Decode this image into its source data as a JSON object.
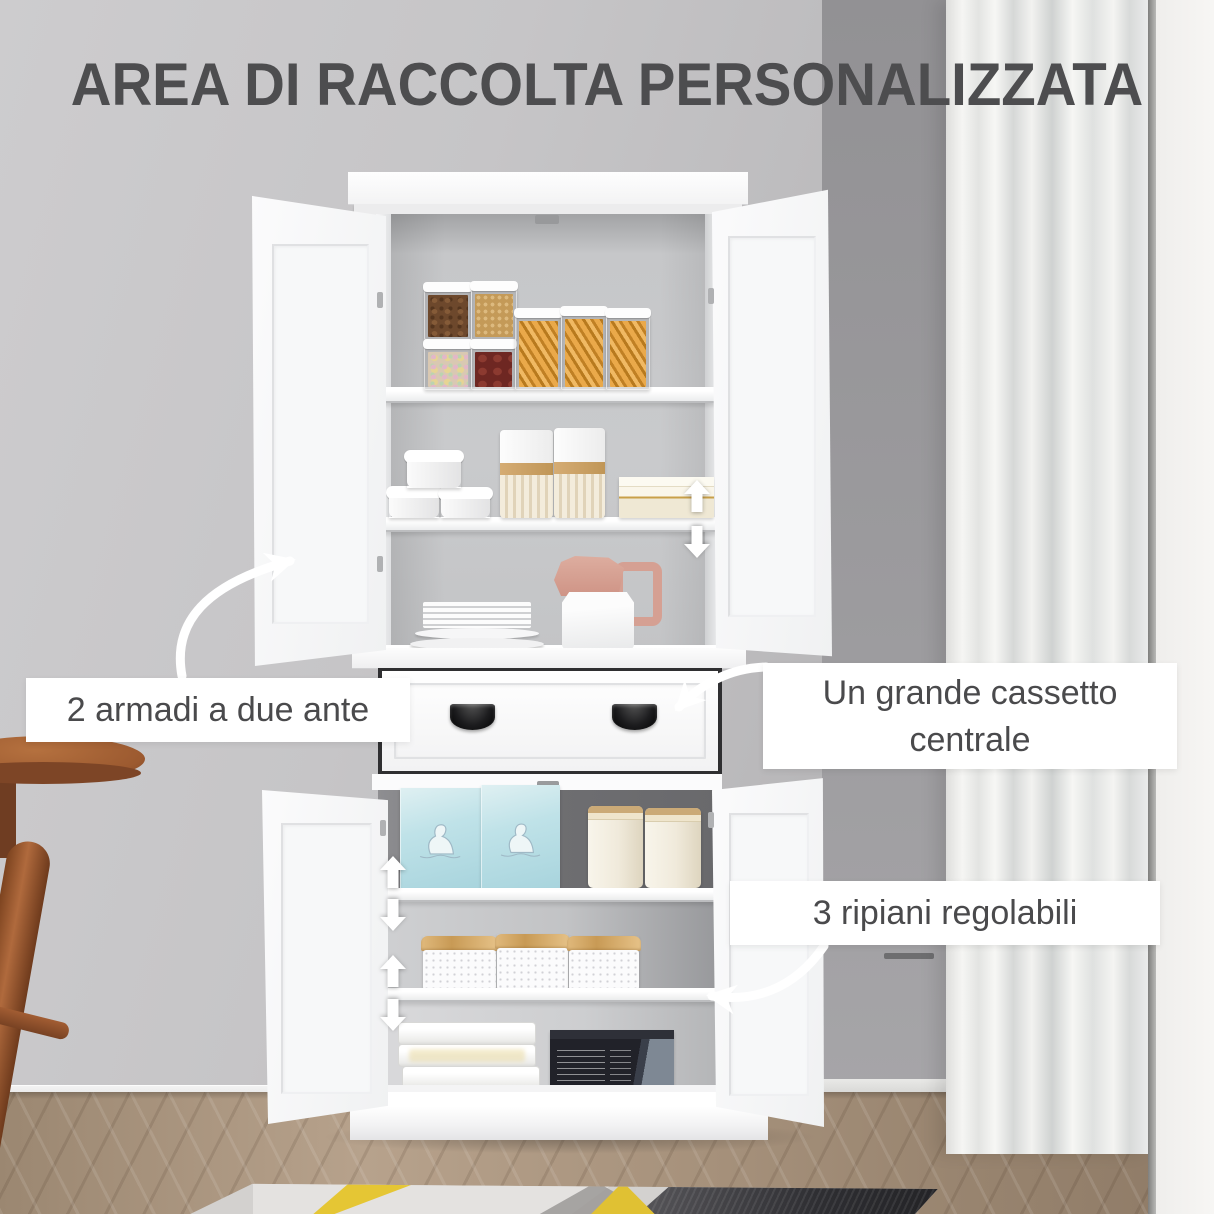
{
  "title": {
    "text": "AREA DI RACCOLTA PERSONALIZZATA"
  },
  "callouts": [
    {
      "id": "two-door-cabinets",
      "text": "2 armadi a due ante"
    },
    {
      "id": "central-drawer",
      "text": "Un grande cassetto centrale"
    },
    {
      "id": "adjustable-shelves",
      "text": "3 ripiani regolabili"
    }
  ],
  "colors": {
    "title_text": "#4d4d4f",
    "callout_text": "#4a4a4c",
    "callout_bg": "#ffffff",
    "annotation_arrow": "#ffffff",
    "cabinet_white": "#fafafb",
    "wall_gray": "#c3c2c4",
    "chair_wood": "#a9653a",
    "rug_yellow": "#e5c634",
    "polar_box_blue": "#bfe2e8"
  },
  "icons": {
    "shelf_adjust_up": "up-arrow",
    "shelf_adjust_down": "down-arrow",
    "callout_pointer": "curved-arrow"
  }
}
